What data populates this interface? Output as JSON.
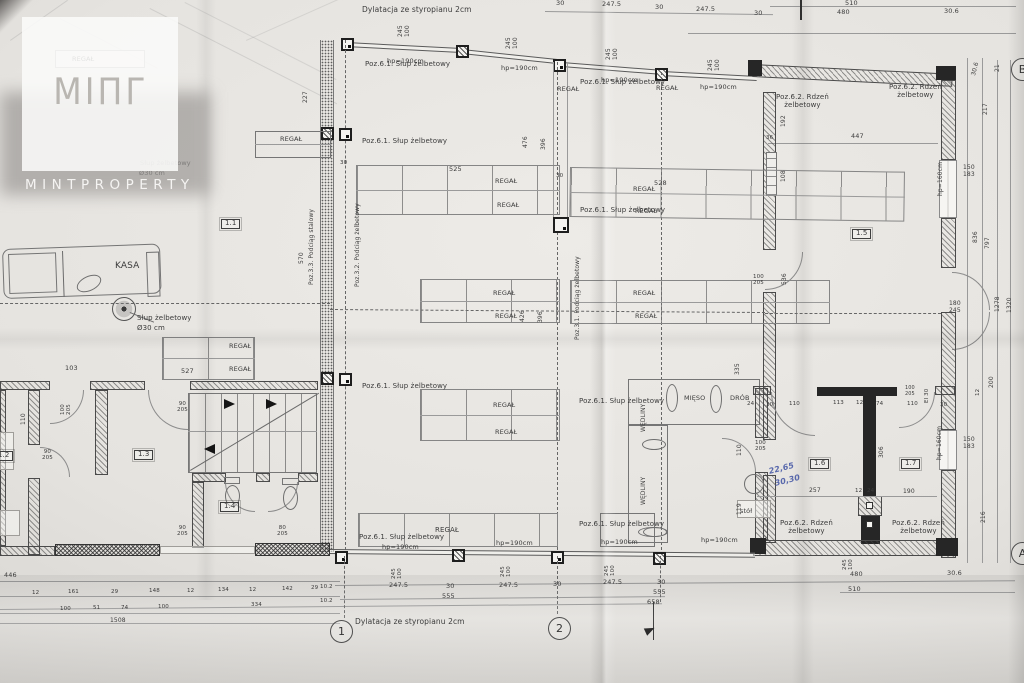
{
  "watermark": {
    "logo_glyph": "MIΠΓ",
    "brand": "MINTPROPERTY"
  },
  "plan": {
    "grid_markers": [
      {
        "label": "1",
        "x": 330,
        "y": 620
      },
      {
        "label": "2",
        "x": 548,
        "y": 617
      },
      {
        "label": "A",
        "x": 1011,
        "y": 542
      },
      {
        "label": "B",
        "x": 1011,
        "y": 58
      }
    ],
    "labels": [
      {
        "t": "Dylatacja ze styropianu 2cm",
        "x": 362,
        "y": 6,
        "s": 7.5
      },
      {
        "t": "30",
        "x": 556,
        "y": 0,
        "s": 6.5
      },
      {
        "t": "247.5",
        "x": 602,
        "y": 1,
        "s": 6.5
      },
      {
        "t": "30",
        "x": 655,
        "y": 4,
        "s": 6.5
      },
      {
        "t": "247.5",
        "x": 696,
        "y": 6,
        "s": 6.5
      },
      {
        "t": "30",
        "x": 754,
        "y": 10,
        "s": 6.5
      },
      {
        "t": "510",
        "x": 845,
        "y": 0,
        "s": 6.5
      },
      {
        "t": "480",
        "x": 837,
        "y": 9,
        "s": 6.5
      },
      {
        "t": "30.6",
        "x": 944,
        "y": 8,
        "s": 6.5
      },
      {
        "t": "245\n100",
        "x": 398,
        "y": 37,
        "r": -90,
        "s": 6,
        "c": "pre"
      },
      {
        "t": "245\n100",
        "x": 506,
        "y": 49,
        "r": -90,
        "s": 6,
        "c": "pre"
      },
      {
        "t": "245\n100",
        "x": 606,
        "y": 60,
        "r": -90,
        "s": 6,
        "c": "pre"
      },
      {
        "t": "245\n100",
        "x": 708,
        "y": 71,
        "r": -90,
        "s": 6,
        "c": "pre"
      },
      {
        "t": "hp=190cm",
        "x": 387,
        "y": 58,
        "s": 6.5
      },
      {
        "t": "hp=190cm",
        "x": 501,
        "y": 65,
        "s": 6.5
      },
      {
        "t": "hp=190cm",
        "x": 601,
        "y": 77,
        "s": 6.5
      },
      {
        "t": "hp=190cm",
        "x": 700,
        "y": 84,
        "s": 6.5
      },
      {
        "t": "Poz.6.1. Słup żelbetowy",
        "x": 365,
        "y": 61,
        "s": 7
      },
      {
        "t": "Poz.6.1. Słup żelbetowy",
        "x": 580,
        "y": 79,
        "s": 7
      },
      {
        "t": "REGAŁ",
        "x": 557,
        "y": 86,
        "s": 6.5
      },
      {
        "t": "REGAŁ",
        "x": 656,
        "y": 85,
        "s": 6.5
      },
      {
        "t": "REGAŁ",
        "x": 72,
        "y": 56,
        "s": 6.5
      },
      {
        "t": "Poz.6.2. Rdzeń\nżelbetowy",
        "x": 776,
        "y": 94,
        "s": 7,
        "c": "pre"
      },
      {
        "t": "Poz.6.2. Rdzeń\nżelbetowy",
        "x": 889,
        "y": 84,
        "s": 7,
        "c": "pre"
      },
      {
        "t": "447",
        "x": 851,
        "y": 133,
        "s": 6.5
      },
      {
        "t": "192",
        "x": 781,
        "y": 127,
        "r": -90,
        "s": 6
      },
      {
        "t": "36",
        "x": 766,
        "y": 135,
        "s": 5.5
      },
      {
        "t": "108",
        "x": 781,
        "y": 182,
        "r": -90,
        "s": 6
      },
      {
        "t": "227",
        "x": 303,
        "y": 103,
        "r": -90,
        "s": 6
      },
      {
        "t": "REGAŁ",
        "x": 280,
        "y": 136,
        "s": 6.5
      },
      {
        "t": "Poz.6.1. Słup żelbetowy",
        "x": 362,
        "y": 138,
        "s": 7
      },
      {
        "t": "30",
        "x": 340,
        "y": 160,
        "s": 5.5
      },
      {
        "t": "Słup żelbetowy",
        "x": 140,
        "y": 160,
        "s": 6.5,
        "c": "faint"
      },
      {
        "t": "Ø30 cm",
        "x": 139,
        "y": 170,
        "s": 6.5,
        "c": "faint"
      },
      {
        "t": "30.6",
        "x": 971,
        "y": 75,
        "r": -75,
        "s": 6
      },
      {
        "t": "21",
        "x": 995,
        "y": 72,
        "r": -90,
        "s": 6
      },
      {
        "t": "217",
        "x": 983,
        "y": 115,
        "r": -90,
        "s": 6
      },
      {
        "t": "hp=160cm",
        "x": 938,
        "y": 196,
        "r": -90,
        "s": 6
      },
      {
        "t": "150\n183",
        "x": 963,
        "y": 165,
        "s": 6,
        "c": "pre"
      },
      {
        "t": "836",
        "x": 973,
        "y": 243,
        "r": -90,
        "s": 6
      },
      {
        "t": "797",
        "x": 985,
        "y": 249,
        "r": -90,
        "s": 6
      },
      {
        "t": "180\n245",
        "x": 949,
        "y": 301,
        "s": 6,
        "c": "pre"
      },
      {
        "t": "1278",
        "x": 995,
        "y": 312,
        "r": -90,
        "s": 6
      },
      {
        "t": "1320",
        "x": 1007,
        "y": 313,
        "r": -90,
        "s": 6
      },
      {
        "t": "200",
        "x": 989,
        "y": 388,
        "r": -90,
        "s": 6
      },
      {
        "t": "12",
        "x": 975,
        "y": 396,
        "r": -90,
        "s": 5.5
      },
      {
        "t": "150\n183",
        "x": 963,
        "y": 437,
        "s": 6,
        "c": "pre"
      },
      {
        "t": "hp=160cm",
        "x": 937,
        "y": 460,
        "r": -90,
        "s": 6
      },
      {
        "t": "216",
        "x": 981,
        "y": 523,
        "r": -90,
        "s": 6
      },
      {
        "t": "1.1",
        "x": 221,
        "y": 219,
        "c": "room"
      },
      {
        "t": "1.5",
        "x": 852,
        "y": 229,
        "c": "room"
      },
      {
        "t": "Poz.3.3. Podciąg stalowy",
        "x": 309,
        "y": 285,
        "r": -90,
        "s": 6
      },
      {
        "t": "570",
        "x": 299,
        "y": 264,
        "r": -90,
        "s": 6
      },
      {
        "t": "Poz.3.2. Podciąg żelbetowy",
        "x": 355,
        "y": 287,
        "r": -90,
        "s": 6
      },
      {
        "t": "Poz.3.1. Podciąg żelbetowy",
        "x": 575,
        "y": 340,
        "r": -90,
        "s": 6
      },
      {
        "t": "525",
        "x": 449,
        "y": 166,
        "s": 6.5
      },
      {
        "t": "528",
        "x": 654,
        "y": 180,
        "s": 6.5
      },
      {
        "t": "REGAŁ",
        "x": 495,
        "y": 178,
        "s": 6.5
      },
      {
        "t": "REGAŁ",
        "x": 497,
        "y": 202,
        "s": 6.5
      },
      {
        "t": "REGAŁ",
        "x": 633,
        "y": 186,
        "s": 6.5
      },
      {
        "t": "REGAŁ",
        "x": 635,
        "y": 208,
        "s": 6.5
      },
      {
        "t": "Poz.6.1. Słup żelbetowy",
        "x": 580,
        "y": 207,
        "s": 7
      },
      {
        "t": "30",
        "x": 556,
        "y": 173,
        "s": 5.5
      },
      {
        "t": "476",
        "x": 523,
        "y": 148,
        "r": -90,
        "s": 6
      },
      {
        "t": "396",
        "x": 541,
        "y": 150,
        "r": -90,
        "s": 6
      },
      {
        "t": "REGAŁ",
        "x": 493,
        "y": 290,
        "s": 6.5
      },
      {
        "t": "REGAŁ",
        "x": 495,
        "y": 313,
        "s": 6.5
      },
      {
        "t": "REGAŁ",
        "x": 633,
        "y": 290,
        "s": 6.5
      },
      {
        "t": "REGAŁ",
        "x": 635,
        "y": 313,
        "s": 6.5
      },
      {
        "t": "426",
        "x": 520,
        "y": 322,
        "r": -90,
        "s": 6
      },
      {
        "t": "396",
        "x": 538,
        "y": 323,
        "r": -90,
        "s": 6
      },
      {
        "t": "KASA",
        "x": 115,
        "y": 261,
        "s": 9
      },
      {
        "t": "Słup żelbetowy",
        "x": 137,
        "y": 315,
        "s": 7
      },
      {
        "t": "Ø30 cm",
        "x": 137,
        "y": 325,
        "s": 7
      },
      {
        "t": "REGAŁ",
        "x": 229,
        "y": 343,
        "s": 6.5
      },
      {
        "t": "REGAŁ",
        "x": 229,
        "y": 366,
        "s": 6.5
      },
      {
        "t": "527",
        "x": 181,
        "y": 368,
        "s": 6.5
      },
      {
        "t": "103",
        "x": 65,
        "y": 365,
        "s": 6.5
      },
      {
        "t": "536",
        "x": 782,
        "y": 285,
        "r": -90,
        "s": 6
      },
      {
        "t": "100\n205",
        "x": 753,
        "y": 274,
        "s": 5.5,
        "c": "pre"
      },
      {
        "t": "1.3",
        "x": 134,
        "y": 450,
        "c": "room"
      },
      {
        "t": "1.2",
        "x": -6,
        "y": 451,
        "c": "room"
      },
      {
        "t": "1.4",
        "x": 220,
        "y": 502,
        "c": "room"
      },
      {
        "t": "100\n205",
        "x": 60,
        "y": 415,
        "r": -90,
        "s": 5.5,
        "c": "pre"
      },
      {
        "t": "90\n205",
        "x": 42,
        "y": 449,
        "s": 5.5,
        "c": "pre"
      },
      {
        "t": "110",
        "x": 21,
        "y": 425,
        "r": -90,
        "s": 6
      },
      {
        "t": "90\n205",
        "x": 177,
        "y": 401,
        "s": 5.5,
        "c": "pre"
      },
      {
        "t": "90\n205",
        "x": 177,
        "y": 525,
        "s": 5.5,
        "c": "pre"
      },
      {
        "t": "80\n205",
        "x": 277,
        "y": 525,
        "s": 5.5,
        "c": "pre"
      },
      {
        "t": "REGAŁ",
        "x": 493,
        "y": 402,
        "s": 6.5
      },
      {
        "t": "REGAŁ",
        "x": 495,
        "y": 429,
        "s": 6.5
      },
      {
        "t": "MIĘSO",
        "x": 684,
        "y": 395,
        "s": 6.5
      },
      {
        "t": "DRÓB",
        "x": 730,
        "y": 395,
        "s": 6.5
      },
      {
        "t": "WĘDLINY",
        "x": 641,
        "y": 432,
        "r": -90,
        "s": 6
      },
      {
        "t": "WĘDLINY",
        "x": 641,
        "y": 505,
        "r": -90,
        "s": 6
      },
      {
        "t": "stół",
        "x": 740,
        "y": 508,
        "s": 6.5
      },
      {
        "t": "335",
        "x": 735,
        "y": 375,
        "r": -90,
        "s": 6
      },
      {
        "t": "110",
        "x": 737,
        "y": 456,
        "r": -90,
        "s": 6
      },
      {
        "t": "119",
        "x": 737,
        "y": 515,
        "r": -90,
        "s": 6
      },
      {
        "t": "100\n205",
        "x": 755,
        "y": 440,
        "s": 5.5,
        "c": "pre"
      },
      {
        "t": "Poz.6.1. Słup żelbetowy",
        "x": 579,
        "y": 398,
        "s": 7
      },
      {
        "t": "Poz.6.1. Słup żelbetowy",
        "x": 579,
        "y": 521,
        "s": 7
      },
      {
        "t": "Poz.6.1. Słup żelbetowy",
        "x": 362,
        "y": 383,
        "s": 7
      },
      {
        "t": "Poz.6.1. Słup żelbetowy",
        "x": 359,
        "y": 534,
        "s": 7
      },
      {
        "t": "hp=190cm",
        "x": 382,
        "y": 544,
        "s": 6.5
      },
      {
        "t": "hp=190cm",
        "x": 496,
        "y": 540,
        "s": 6.5
      },
      {
        "t": "hp=190cm",
        "x": 601,
        "y": 539,
        "s": 6.5
      },
      {
        "t": "hp=190cm",
        "x": 701,
        "y": 537,
        "s": 6.5
      },
      {
        "t": "REGAŁ",
        "x": 435,
        "y": 527,
        "s": 7
      },
      {
        "t": "1.6",
        "x": 810,
        "y": 459,
        "c": "room"
      },
      {
        "t": "1.7",
        "x": 901,
        "y": 459,
        "c": "room"
      },
      {
        "t": "257",
        "x": 809,
        "y": 488,
        "s": 6
      },
      {
        "t": "12",
        "x": 855,
        "y": 488,
        "s": 5.5
      },
      {
        "t": "24",
        "x": 867,
        "y": 488,
        "s": 5.5
      },
      {
        "t": "190",
        "x": 903,
        "y": 489,
        "s": 6
      },
      {
        "t": "24",
        "x": 747,
        "y": 401,
        "s": 5.5
      },
      {
        "t": "30",
        "x": 766,
        "y": 402,
        "s": 5.5
      },
      {
        "t": "110",
        "x": 789,
        "y": 401,
        "s": 5.5
      },
      {
        "t": "113",
        "x": 833,
        "y": 400,
        "s": 5.5
      },
      {
        "t": "12",
        "x": 856,
        "y": 400,
        "s": 5.5
      },
      {
        "t": "74",
        "x": 876,
        "y": 401,
        "s": 5.5
      },
      {
        "t": "110",
        "x": 907,
        "y": 401,
        "s": 5.5
      },
      {
        "t": "30",
        "x": 940,
        "y": 402,
        "s": 5.5
      },
      {
        "t": "306",
        "x": 879,
        "y": 458,
        "r": -90,
        "s": 6
      },
      {
        "t": "100\n205",
        "x": 905,
        "y": 386,
        "s": 5,
        "c": "pre"
      },
      {
        "t": "EI 30",
        "x": 924,
        "y": 403,
        "r": -90,
        "s": 5.5
      },
      {
        "t": "Poz.6.2. Rdzeń\nżelbetowy",
        "x": 780,
        "y": 520,
        "s": 7,
        "c": "pre"
      },
      {
        "t": "Poz.6.2. Rdzeń\nżelbetowy",
        "x": 892,
        "y": 520,
        "s": 7,
        "c": "pre"
      },
      {
        "t": "22,65",
        "x": 768,
        "y": 468,
        "r": -14,
        "s": 8,
        "c": "blue"
      },
      {
        "t": "30,30",
        "x": 774,
        "y": 480,
        "r": -14,
        "s": 8,
        "c": "blue"
      },
      {
        "t": "480",
        "x": 850,
        "y": 571,
        "s": 6.5
      },
      {
        "t": "30.6",
        "x": 947,
        "y": 570,
        "s": 6.5
      },
      {
        "t": "510",
        "x": 848,
        "y": 586,
        "s": 6.5
      },
      {
        "t": "247.5",
        "x": 389,
        "y": 582,
        "s": 6.5
      },
      {
        "t": "30",
        "x": 446,
        "y": 583,
        "s": 6.5
      },
      {
        "t": "247.5",
        "x": 499,
        "y": 582,
        "s": 6.5
      },
      {
        "t": "30",
        "x": 553,
        "y": 581,
        "s": 6.5
      },
      {
        "t": "247.5",
        "x": 603,
        "y": 579,
        "s": 6.5
      },
      {
        "t": "30",
        "x": 657,
        "y": 579,
        "s": 6.5
      },
      {
        "t": "555",
        "x": 442,
        "y": 593,
        "s": 6.5
      },
      {
        "t": "555",
        "x": 653,
        "y": 589,
        "s": 6.5
      },
      {
        "t": "658",
        "x": 647,
        "y": 599,
        "s": 6.5
      },
      {
        "t": "245\n100",
        "x": 391,
        "y": 579,
        "r": -90,
        "s": 5.5,
        "c": "pre"
      },
      {
        "t": "245\n100",
        "x": 500,
        "y": 577,
        "r": -90,
        "s": 5.5,
        "c": "pre"
      },
      {
        "t": "245\n100",
        "x": 604,
        "y": 576,
        "r": -90,
        "s": 5.5,
        "c": "pre"
      },
      {
        "t": "245\n100",
        "x": 842,
        "y": 570,
        "r": -90,
        "s": 5.5,
        "c": "pre"
      },
      {
        "t": "Dylatacja ze styropianu 2cm",
        "x": 355,
        "y": 618,
        "s": 7.5
      },
      {
        "t": "446",
        "x": 4,
        "y": 572,
        "s": 6.5
      },
      {
        "t": "12",
        "x": 32,
        "y": 590,
        "s": 5.5
      },
      {
        "t": "161",
        "x": 68,
        "y": 589,
        "s": 5.5
      },
      {
        "t": "29",
        "x": 111,
        "y": 589,
        "s": 5.5
      },
      {
        "t": "148",
        "x": 149,
        "y": 588,
        "s": 5.5
      },
      {
        "t": "12",
        "x": 187,
        "y": 588,
        "s": 5.5
      },
      {
        "t": "134",
        "x": 218,
        "y": 587,
        "s": 5.5
      },
      {
        "t": "12",
        "x": 249,
        "y": 587,
        "s": 5.5
      },
      {
        "t": "142",
        "x": 282,
        "y": 586,
        "s": 5.5
      },
      {
        "t": "29",
        "x": 311,
        "y": 585,
        "s": 5.5
      },
      {
        "t": "10.2",
        "x": 320,
        "y": 584,
        "s": 5.5
      },
      {
        "t": "100",
        "x": 60,
        "y": 606,
        "s": 5.5
      },
      {
        "t": "51",
        "x": 93,
        "y": 605,
        "s": 5.5
      },
      {
        "t": "74",
        "x": 121,
        "y": 605,
        "s": 5.5
      },
      {
        "t": "100",
        "x": 158,
        "y": 604,
        "s": 5.5
      },
      {
        "t": "334",
        "x": 251,
        "y": 602,
        "s": 5.5
      },
      {
        "t": "10.2",
        "x": 320,
        "y": 598,
        "s": 5.5
      },
      {
        "t": "1508",
        "x": 110,
        "y": 618,
        "s": 6
      }
    ]
  }
}
